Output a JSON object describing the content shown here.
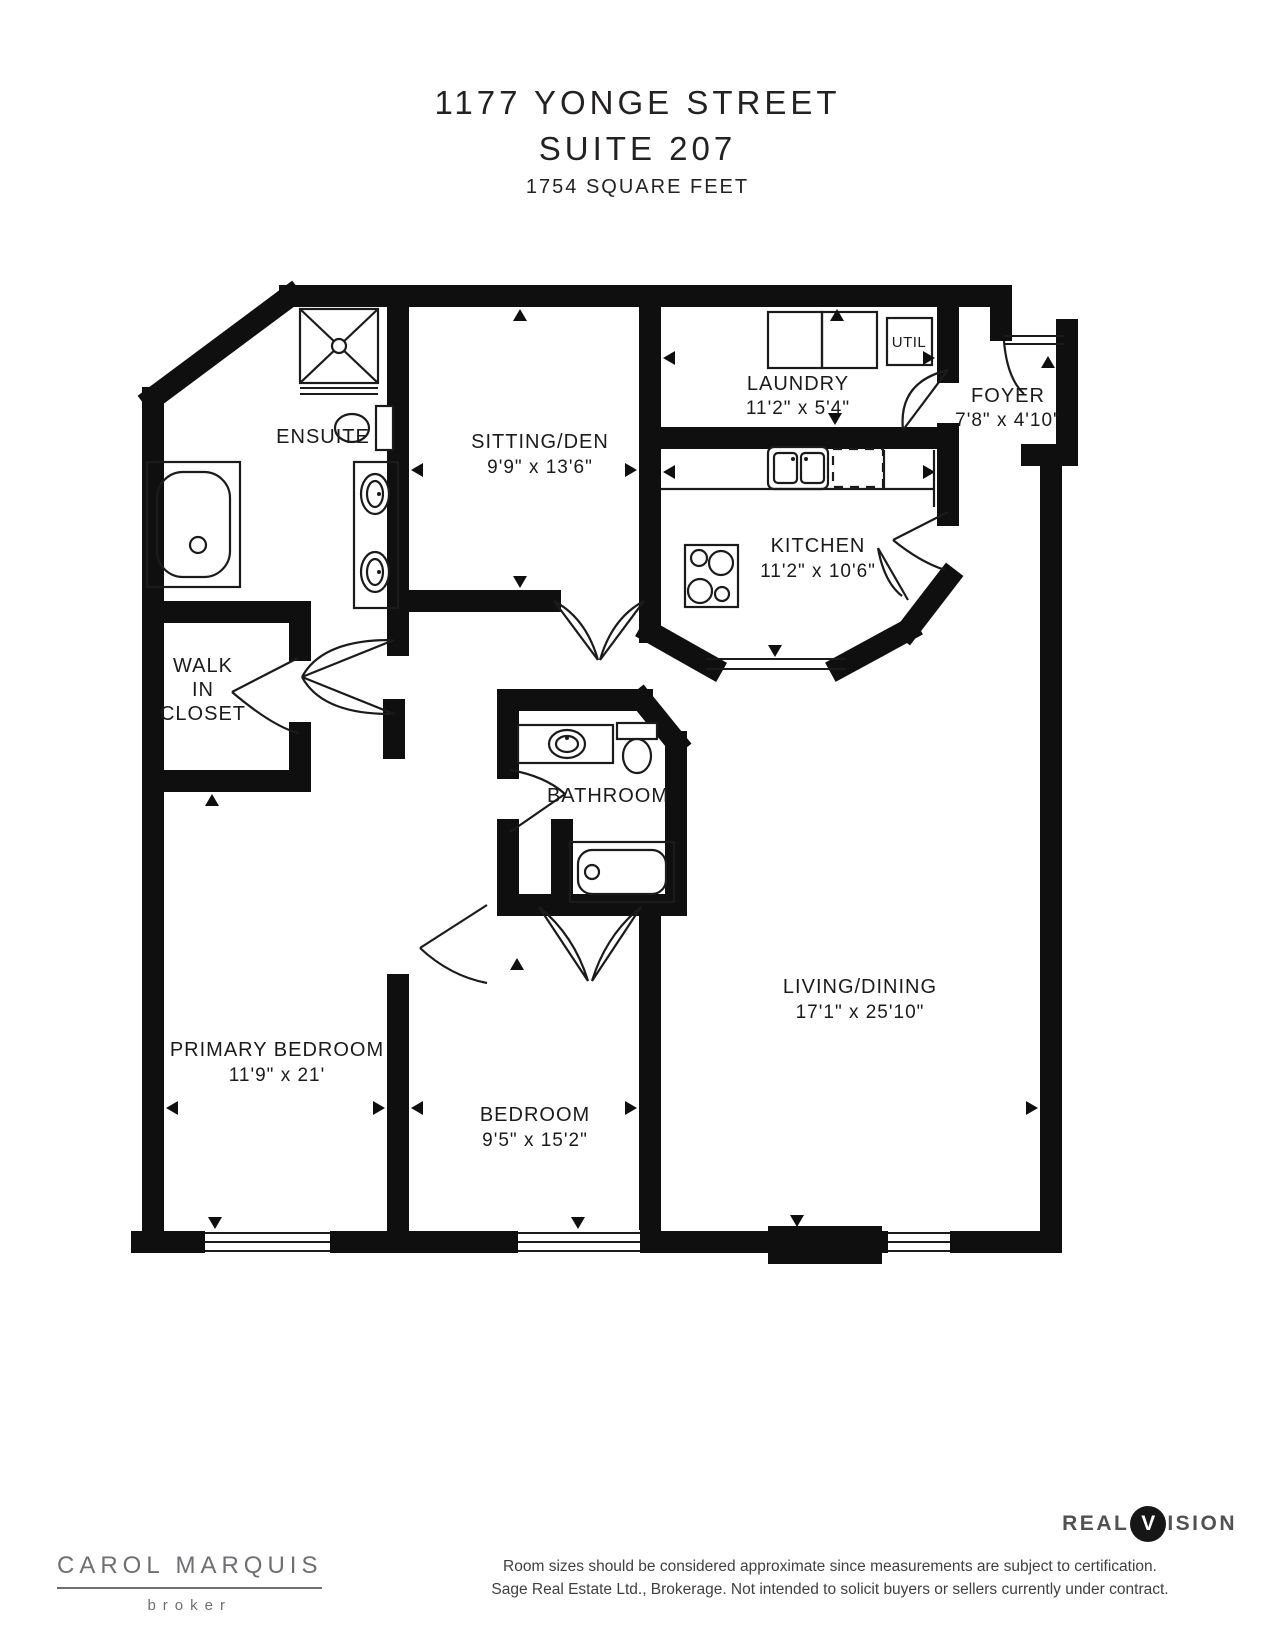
{
  "header": {
    "line1": "1177 YONGE STREET",
    "line2": "SUITE 207",
    "line3": "1754 SQUARE FEET"
  },
  "rooms": {
    "ensuite": {
      "name": "ENSUITE"
    },
    "sitting_den": {
      "name": "SITTING/DEN",
      "dims": "9'9\" x 13'6\""
    },
    "laundry": {
      "name": "LAUNDRY",
      "dims": "11'2\" x 5'4\""
    },
    "util": {
      "name": "UTIL"
    },
    "foyer": {
      "name": "FOYER",
      "dims": "7'8\" x 4'10\""
    },
    "kitchen": {
      "name": "KITCHEN",
      "dims": "11'2\" x 10'6\""
    },
    "walk_in_closet": {
      "line1": "WALK",
      "line2": "IN",
      "line3": "CLOSET"
    },
    "bathroom": {
      "name": "BATHROOM"
    },
    "primary_bedroom": {
      "name": "PRIMARY BEDROOM",
      "dims": "11'9\" x 21'"
    },
    "bedroom": {
      "name": "BEDROOM",
      "dims": "9'5\" x 15'2\""
    },
    "living_dining": {
      "name": "LIVING/DINING",
      "dims": "17'1\" x 25'10\""
    }
  },
  "footer": {
    "agent_name": "CAROL MARQUIS",
    "agent_title": "broker",
    "logo": {
      "part1": "REAL",
      "circle_letter": "V",
      "part2": "ISION"
    },
    "disclaimer_line1": "Room sizes should be considered approximate since measurements are subject to certification.",
    "disclaimer_line2": "Sage Real Estate Ltd., Brokerage. Not intended to solicit buyers or sellers currently under contract."
  },
  "colors": {
    "wall": "#0f0f0f",
    "label_text": "#1b1b1b",
    "footer_gray": "#6e6f72",
    "logo_gray": "#515254",
    "disclaimer_gray": "#3f4042"
  }
}
